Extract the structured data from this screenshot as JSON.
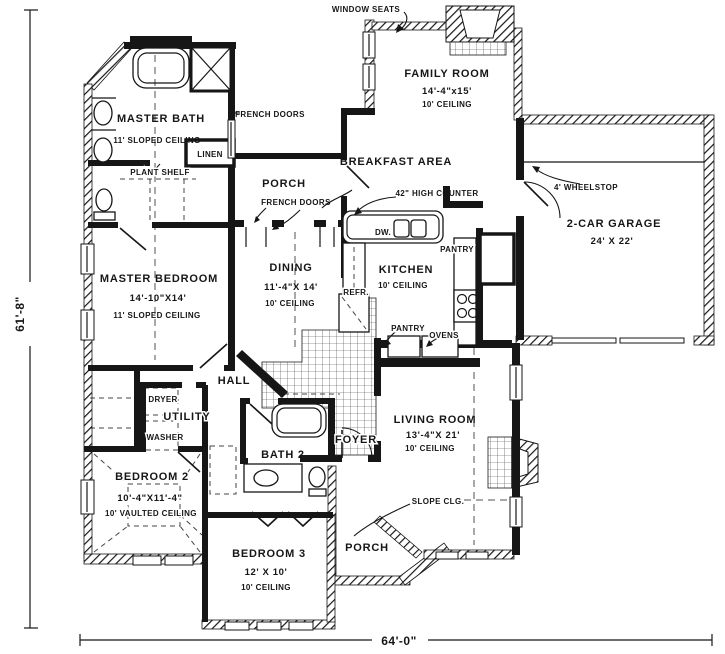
{
  "drawing": {
    "type": "single-story house floor plan"
  },
  "dimensions": {
    "left": "61'-8\"",
    "bottom": "64'-0\""
  },
  "rooms": {
    "master_bath": {
      "name": "MASTER BATH",
      "ceiling": "11' SLOPED CEILING"
    },
    "family_room": {
      "name": "FAMILY ROOM",
      "size": "14'-4\"x15'",
      "ceiling": "10' CEILING"
    },
    "breakfast_area": {
      "name": "BREAKFAST AREA"
    },
    "porch_upper": {
      "name": "PORCH"
    },
    "dining": {
      "name": "DINING",
      "size": "11'-4\"X 14'",
      "ceiling": "10' CEILING"
    },
    "kitchen": {
      "name": "KITCHEN",
      "ceiling": "10' CEILING"
    },
    "garage": {
      "name": "2-CAR GARAGE",
      "size": "24' X 22'"
    },
    "master_bedroom": {
      "name": "MASTER BEDROOM",
      "size": "14'-10\"X14'",
      "ceiling": "11' SLOPED CEILING"
    },
    "hall": {
      "name": "HALL"
    },
    "utility": {
      "name": "UTILITY"
    },
    "living_room": {
      "name": "LIVING ROOM",
      "size": "13'-4\"X 21'",
      "ceiling": "10' CEILING"
    },
    "bedroom_2": {
      "name": "BEDROOM 2",
      "size": "10'-4\"X11'-4\"",
      "ceiling": "10' VAULTED CEILING"
    },
    "bath_2": {
      "name": "BATH 2"
    },
    "foyer": {
      "name": "FOYER"
    },
    "bedroom_3": {
      "name": "BEDROOM 3",
      "size": "12' X 10'",
      "ceiling": "10' CEILING"
    },
    "porch_lower": {
      "name": "PORCH"
    }
  },
  "annotations": {
    "window_seats": "WINDOW SEATS",
    "french_doors_master": "FRENCH DOORS",
    "french_doors_porch": "FRENCH DOORS",
    "linen": "LINEN",
    "plant_shelf": "PLANT SHELF",
    "high_counter": "42\" HIGH COUNTER",
    "wheelstop": "4' WHEELSTOP",
    "dishwasher": "DW.",
    "refrigerator": "REFR.",
    "pantry_upper": "PANTRY",
    "pantry_lower": "PANTRY",
    "ovens": "OVENS",
    "dryer": "DRYER",
    "washer": "WASHER",
    "slope_ceiling": "SLOPE CLG."
  },
  "colors": {
    "ink": "#161616",
    "paper": "#ffffff"
  }
}
